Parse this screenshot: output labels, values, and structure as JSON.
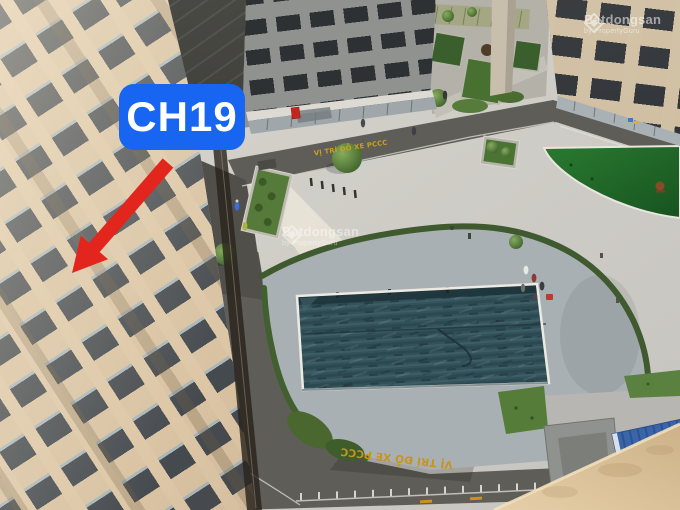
{
  "annotation": {
    "apartment_label": "CH19"
  },
  "watermark": {
    "brand": "Batdongsan",
    "byline": "by PropertyGuru"
  },
  "road_markings": {
    "fire_truck_zone_top": "VỊ TRÍ ĐỖ XE PCCC",
    "fire_truck_zone_bottom": "VỊ TRÍ ĐỖ XE PCCC"
  },
  "colors": {
    "label_blue": "#1765f0",
    "arrow_red": "#e2261d",
    "pool_water": "#35545c",
    "lawn_green": "#1d6326",
    "marking_yellow": "#c9a11d",
    "watermark_white": "#ffffff"
  }
}
